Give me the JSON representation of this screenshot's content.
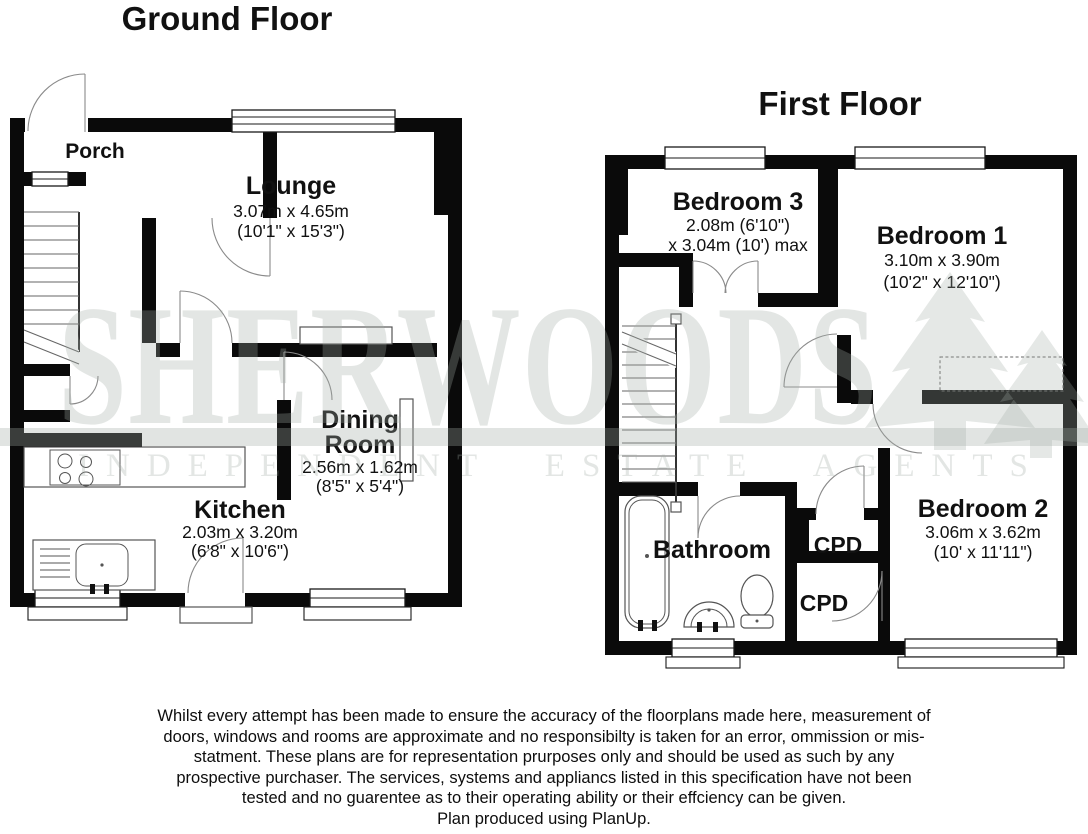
{
  "titles": {
    "ground_floor": "Ground Floor",
    "first_floor": "First Floor"
  },
  "ground_floor": {
    "porch": {
      "name": "Porch"
    },
    "lounge": {
      "name": "Lounge",
      "dim_metric": "3.07m x 4.65m",
      "dim_imperial": "(10'1\" x 15'3\")"
    },
    "dining": {
      "name_line1": "Dining",
      "name_line2": "Room",
      "dim_metric": "2.56m x 1.62m",
      "dim_imperial": "(8'5\" x 5'4\")"
    },
    "kitchen": {
      "name": "Kitchen",
      "dim_metric": "2.03m x 3.20m",
      "dim_imperial": "(6'8\" x 10'6\")"
    }
  },
  "first_floor": {
    "bedroom3": {
      "name": "Bedroom 3",
      "dim_line1": "2.08m (6'10\")",
      "dim_line2": "x 3.04m (10') max"
    },
    "bedroom1": {
      "name": "Bedroom 1",
      "dim_metric": "3.10m x 3.90m",
      "dim_imperial": "(10'2\" x 12'10\")"
    },
    "bedroom2": {
      "name": "Bedroom 2",
      "dim_metric": "3.06m x 3.62m",
      "dim_imperial": "(10' x 11'11\")"
    },
    "bathroom": {
      "name": "Bathroom"
    },
    "cupboard1": {
      "name": "CPD"
    },
    "cupboard2": {
      "name": "CPD"
    }
  },
  "watermark": {
    "brand": "SHERWOODS",
    "tagline": "INDEPENDENT ESTATE AGENTS",
    "color": "#a2aca4",
    "icons": [
      "pine-tree-icon-large",
      "pine-tree-icon-small"
    ]
  },
  "disclaimer": {
    "lines": [
      "Whilst every attempt has been made to ensure the accuracy of the floorplans made here, measurement of",
      "doors, windows and rooms are approximate and no responsibilty is taken for an error, ommission or mis-",
      "statment. These plans are for representation prurposes only and should be used as such by any",
      "prospective purchaser. The services, systems and appliancs listed in this specification have not been",
      "tested and no guarentee as to their operating ability or their effciency can be given."
    ],
    "produced_by": "Plan produced using PlanUp."
  }
}
